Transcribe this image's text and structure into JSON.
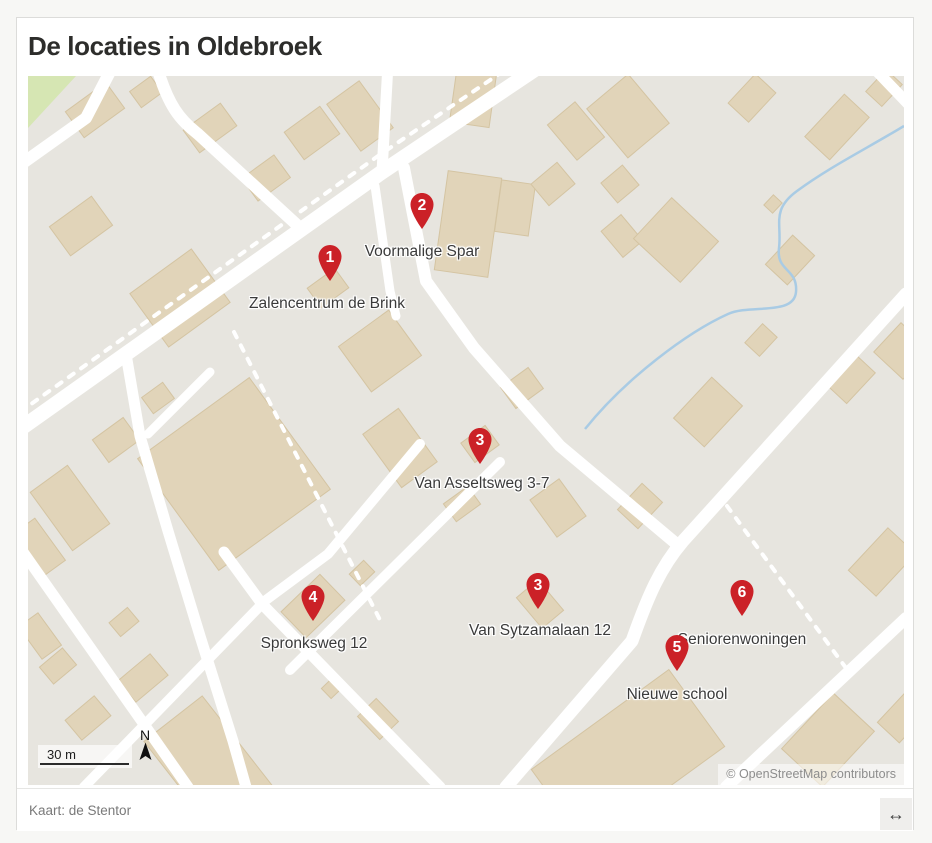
{
  "title": "De locaties in Oldebroek",
  "map": {
    "markers": [
      {
        "number": "1",
        "label": "Zalencentrum de Brink",
        "tip_x": 302,
        "tip_y": 205,
        "label_x": 299,
        "label_y": 228
      },
      {
        "number": "2",
        "label": "Voormalige Spar",
        "tip_x": 394,
        "tip_y": 153,
        "label_x": 394,
        "label_y": 176
      },
      {
        "number": "3",
        "label": "Van Asseltsweg 3-7",
        "tip_x": 452,
        "tip_y": 388,
        "label_x": 454,
        "label_y": 408
      },
      {
        "number": "3",
        "label": "Van Sytzamalaan 12",
        "tip_x": 510,
        "tip_y": 533,
        "label_x": 512,
        "label_y": 555
      },
      {
        "number": "4",
        "label": "Spronksweg 12",
        "tip_x": 285,
        "tip_y": 545,
        "label_x": 286,
        "label_y": 568
      },
      {
        "number": "6",
        "label": "Seniorenwoningen",
        "tip_x": 714,
        "tip_y": 540,
        "label_x": 714,
        "label_y": 564
      },
      {
        "number": "5",
        "label": "Nieuwe school",
        "tip_x": 649,
        "tip_y": 595,
        "label_x": 649,
        "label_y": 619
      }
    ],
    "scale_label": "30 m",
    "north_label": "N",
    "attribution": "© OpenStreetMap contributors"
  },
  "footer": {
    "caption": "Kaart: de Stentor",
    "resize_icon": "↔"
  },
  "colors": {
    "marker_red": "#cb2127",
    "marker_number": "#ffffff",
    "road": "#ffffff",
    "building_fill": "#e1d4b9",
    "building_stroke": "#d4c4a2",
    "map_background": "#e7e5df",
    "water": "#a9cbe4",
    "greenery": "#d6e6b3"
  }
}
